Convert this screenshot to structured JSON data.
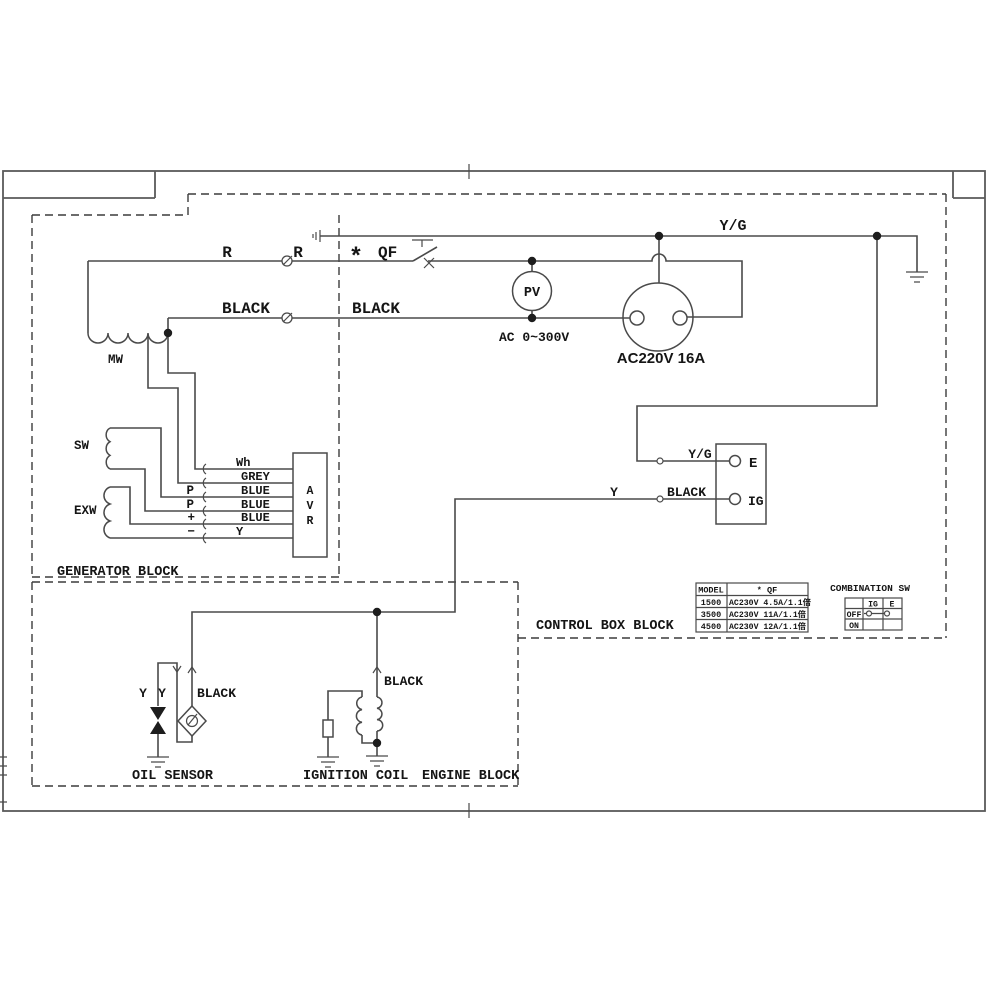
{
  "blocks": {
    "generator": "GENERATOR BLOCK",
    "control_box": "CONTROL BOX BLOCK",
    "engine": "ENGINE BLOCK"
  },
  "windings": {
    "mw": "MW",
    "sw": "SW",
    "exw": "EXW"
  },
  "avr": {
    "letters": [
      "A",
      "V",
      "R"
    ],
    "pins_left": [
      "P",
      "P",
      "+",
      "−"
    ],
    "pins_right": [
      "Wh",
      "GREY",
      "BLUE",
      "BLUE",
      "BLUE",
      "Y"
    ]
  },
  "breaker": {
    "star": "*",
    "label": "QF"
  },
  "meter": {
    "label": "PV",
    "range": "AC 0~300V"
  },
  "socket": {
    "label": "AC220V 16A"
  },
  "terminal_block": {
    "e": "E",
    "ig": "IG"
  },
  "wires": {
    "r_gen": "R",
    "r_out": "R",
    "black_gen": "BLACK",
    "black_out": "BLACK",
    "yg_main": "Y/G",
    "yg_e": "Y/G",
    "y_ig": "Y",
    "black_ig": "BLACK",
    "black_oil": "BLACK",
    "y_oil_1": "Y",
    "y_oil_2": "Y",
    "black_ign": "BLACK"
  },
  "engine_parts": {
    "oil_sensor": "OIL SENSOR",
    "ignition_coil": "IGNITION COIL"
  },
  "model_table": {
    "headers": [
      "MODEL",
      "* QF"
    ],
    "rows": [
      [
        "1500",
        "AC230V 4.5A/1.1倍"
      ],
      [
        "3500",
        "AC230V 11A/1.1倍"
      ],
      [
        "4500",
        "AC230V 12A/1.1倍"
      ]
    ]
  },
  "combination_sw": {
    "title": "COMBINATION SW",
    "columns": [
      "IG",
      "E"
    ],
    "rows": [
      "OFF",
      "ON"
    ]
  }
}
